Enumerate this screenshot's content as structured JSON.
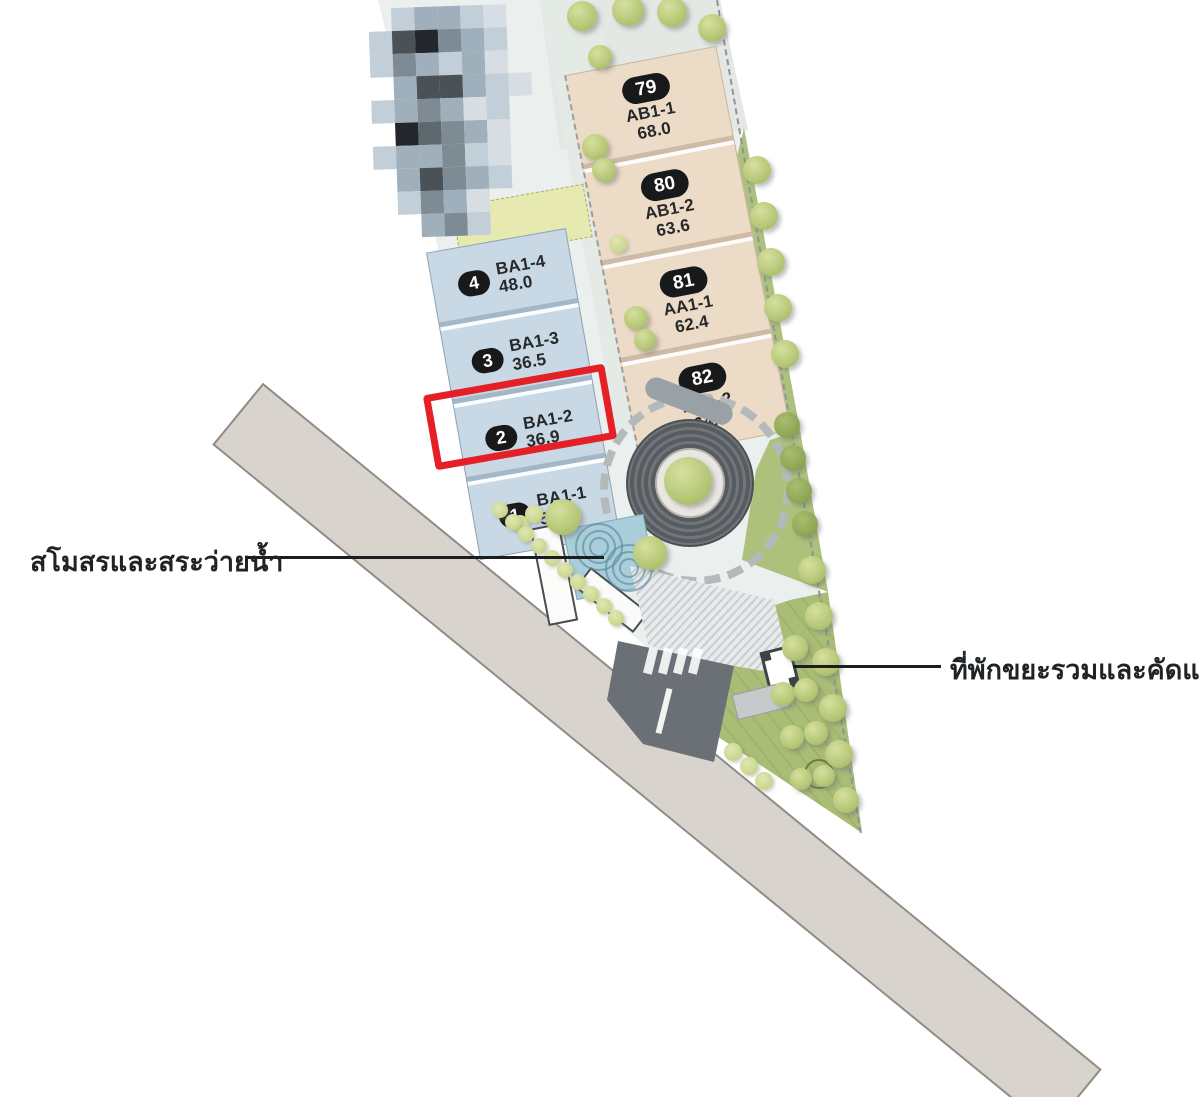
{
  "labels": {
    "clubhouse_pool": "สโมสรและสระว่ายน้ำ",
    "waste_sorting": "ที่พักขยะรวมและคัดแยก"
  },
  "lots": {
    "blue": [
      {
        "no": "4",
        "code": "BA1-4",
        "area": "48.0"
      },
      {
        "no": "3",
        "code": "BA1-3",
        "area": "36.5"
      },
      {
        "no": "2",
        "code": "BA1-2",
        "area": "36.9",
        "highlighted": true
      },
      {
        "no": "1",
        "code": "BA1-1",
        "area": "54.2"
      }
    ],
    "beige": [
      {
        "no": "79",
        "code": "AB1-1",
        "area": "68.0"
      },
      {
        "no": "80",
        "code": "AB1-2",
        "area": "63.6"
      },
      {
        "no": "81",
        "code": "AA1-1",
        "area": "62.4"
      },
      {
        "no": "82",
        "code": "AA1-2",
        "area": "64.9"
      }
    ]
  },
  "colors": {
    "highlight_red": "#e41f26",
    "lot_blue": "#c8d8e4",
    "lot_beige": "#ecdbc7",
    "lawn_green": "#aec17c",
    "road_gray": "#d8d4cd",
    "entry_road": "#6a7076",
    "pool_blue": "#a9cdd9",
    "pill_black": "#17191b"
  },
  "mosaic": {
    "palette": {
      "A": "#c2cfd8",
      "B": "#9fb0bc",
      "C": "#7e8b94",
      "D": "#4a5258",
      "E": "#23272b",
      "F": "#d6dee3",
      "G": "#5d686f"
    },
    "rows": [
      ".ABBAF.",
      "ADECBA.",
      "ACBABF.",
      ".BDDBAF",
      "ABCBFA.",
      ".EGCBF.",
      "ABBCAF.",
      ".BDCBA.",
      ".ACBF..",
      "..BCA.."
    ]
  },
  "decor": {
    "trees": [
      [
        582,
        16,
        15
      ],
      [
        628,
        10,
        16
      ],
      [
        672,
        12,
        15
      ],
      [
        712,
        28,
        14
      ],
      [
        600,
        57,
        12
      ],
      [
        595,
        147,
        13
      ],
      [
        604,
        170,
        12
      ],
      [
        636,
        318,
        12
      ],
      [
        645,
        340,
        11
      ],
      [
        757,
        170,
        14
      ],
      [
        764,
        216,
        14
      ],
      [
        771,
        262,
        14
      ],
      [
        778,
        308,
        14
      ],
      [
        785,
        354,
        14
      ],
      [
        812,
        570,
        14
      ],
      [
        819,
        616,
        14
      ],
      [
        826,
        662,
        14
      ],
      [
        833,
        708,
        14
      ],
      [
        839,
        754,
        14
      ],
      [
        846,
        800,
        13
      ],
      [
        563,
        517,
        18
      ],
      [
        650,
        553,
        17
      ],
      [
        795,
        648,
        13
      ],
      [
        783,
        694,
        12
      ],
      [
        806,
        690,
        12
      ],
      [
        792,
        737,
        12
      ],
      [
        816,
        733,
        12
      ],
      [
        801,
        779,
        11
      ],
      [
        824,
        776,
        11
      ]
    ],
    "dark_trees": [
      [
        787,
        425,
        13
      ],
      [
        793,
        458,
        13
      ],
      [
        799,
        491,
        13
      ],
      [
        805,
        524,
        13
      ]
    ],
    "bushes": [
      [
        520,
        524,
        9
      ],
      [
        534,
        514,
        9
      ],
      [
        618,
        244,
        9
      ],
      [
        500,
        510,
        8
      ],
      [
        513,
        522,
        8
      ],
      [
        526,
        534,
        8
      ],
      [
        539,
        546,
        8
      ],
      [
        552,
        558,
        8
      ],
      [
        565,
        570,
        8
      ],
      [
        578,
        582,
        8
      ],
      [
        591,
        594,
        8
      ],
      [
        604,
        606,
        8
      ],
      [
        616,
        618,
        8
      ],
      [
        733,
        752,
        9
      ],
      [
        749,
        766,
        9
      ],
      [
        764,
        781,
        9
      ]
    ],
    "ripples": [
      [
        597,
        545
      ],
      [
        627,
        566
      ]
    ],
    "zebra_x": [
      646,
      661,
      676,
      691
    ]
  }
}
